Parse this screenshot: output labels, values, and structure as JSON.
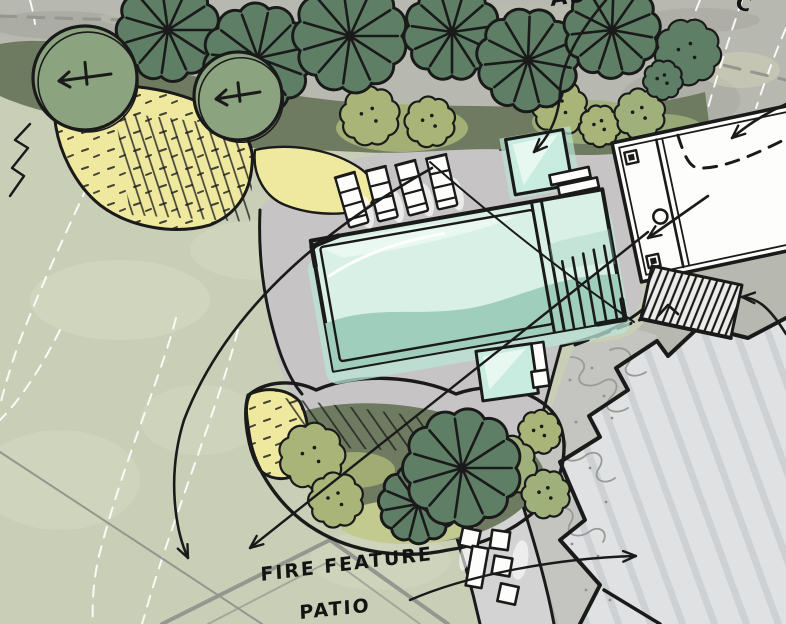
{
  "meta": {
    "drawing_type": "hand-drawn landscape site plan sketch"
  },
  "labels": {
    "aster": "ASTER",
    "c": "C",
    "fire_line1": "FIRE FEATURE",
    "fire_line2": "PATIO"
  },
  "counts": {
    "lounge_chairs": 4,
    "patio_chairs": 4,
    "patio_benches": 1,
    "spas": 2
  },
  "palette": {
    "photo_bg": "#b7b8b0",
    "photo_dark": "#9fa098",
    "lawn": "#c9cfb6",
    "lawn_light": "#d5dac2",
    "patio": "#c6c4c5",
    "walkway": "#d4d3d4",
    "pool_light": "#d9f0e6",
    "pool_dark": "#9fcebd",
    "pool_glow": "#b9e4d6",
    "ink": "#1a1a1a",
    "tree_dark": "#5e7f66",
    "tree_sage": "#8ba37f",
    "underlay_dark": "#6e7b60",
    "shrub_yellow": "#efe9a0",
    "shrub_olive": "#a9b578",
    "shrub_light": "#9fb07b",
    "bank_light": "#c2ca8f",
    "house_roof": "#dfe1e3",
    "roof_line": "#c9cdd0",
    "existing_gray": "#c4c4c0",
    "contour_white": "#ffffff",
    "prop_gray": "#95968f"
  },
  "scene": {
    "plants": [
      {
        "t": "shrub",
        "l": "top",
        "x": 370,
        "y": 116,
        "r": 27,
        "c": "shrub_olive"
      },
      {
        "t": "shrub",
        "l": "top",
        "x": 430,
        "y": 122,
        "r": 23,
        "c": "shrub_olive"
      },
      {
        "t": "shrub",
        "l": "top",
        "x": 560,
        "y": 108,
        "r": 25,
        "c": "shrub_olive"
      },
      {
        "t": "shrub",
        "l": "top",
        "x": 600,
        "y": 126,
        "r": 19,
        "c": "shrub_olive"
      },
      {
        "t": "shrub",
        "l": "top",
        "x": 640,
        "y": 114,
        "r": 23,
        "c": "shrub_light"
      },
      {
        "t": "shrub",
        "l": "top",
        "x": 688,
        "y": 52,
        "r": 30,
        "c": "tree_dark"
      },
      {
        "t": "shrub",
        "l": "top",
        "x": 663,
        "y": 80,
        "r": 18,
        "c": "tree_dark"
      },
      {
        "t": "radial",
        "l": "top",
        "x": 168,
        "y": 30,
        "r": 47
      },
      {
        "t": "radial",
        "l": "top",
        "x": 258,
        "y": 58,
        "r": 50
      },
      {
        "t": "radial",
        "l": "top",
        "x": 350,
        "y": 36,
        "r": 52
      },
      {
        "t": "radial",
        "l": "top",
        "x": 452,
        "y": 32,
        "r": 44
      },
      {
        "t": "radial",
        "l": "top",
        "x": 528,
        "y": 60,
        "r": 47
      },
      {
        "t": "radial",
        "l": "top",
        "x": 612,
        "y": 30,
        "r": 44
      },
      {
        "t": "round",
        "l": "top",
        "x": 85,
        "y": 78,
        "r": 52
      },
      {
        "t": "round",
        "l": "top",
        "x": 238,
        "y": 96,
        "r": 44
      },
      {
        "t": "shrub",
        "l": "bed",
        "x": 312,
        "y": 456,
        "r": 30,
        "c": "shrub_olive"
      },
      {
        "t": "shrub",
        "l": "bed",
        "x": 336,
        "y": 500,
        "r": 25,
        "c": "shrub_olive"
      },
      {
        "t": "shrub",
        "l": "bed",
        "x": 540,
        "y": 432,
        "r": 20,
        "c": "shrub_olive"
      },
      {
        "t": "shrub",
        "l": "bed",
        "x": 506,
        "y": 466,
        "r": 28,
        "c": "shrub_light"
      },
      {
        "t": "shrub",
        "l": "bed",
        "x": 546,
        "y": 494,
        "r": 22,
        "c": "shrub_light"
      },
      {
        "t": "radial",
        "l": "bed",
        "x": 418,
        "y": 504,
        "r": 36
      },
      {
        "t": "radial",
        "l": "bed",
        "x": 462,
        "y": 468,
        "r": 54
      }
    ]
  }
}
